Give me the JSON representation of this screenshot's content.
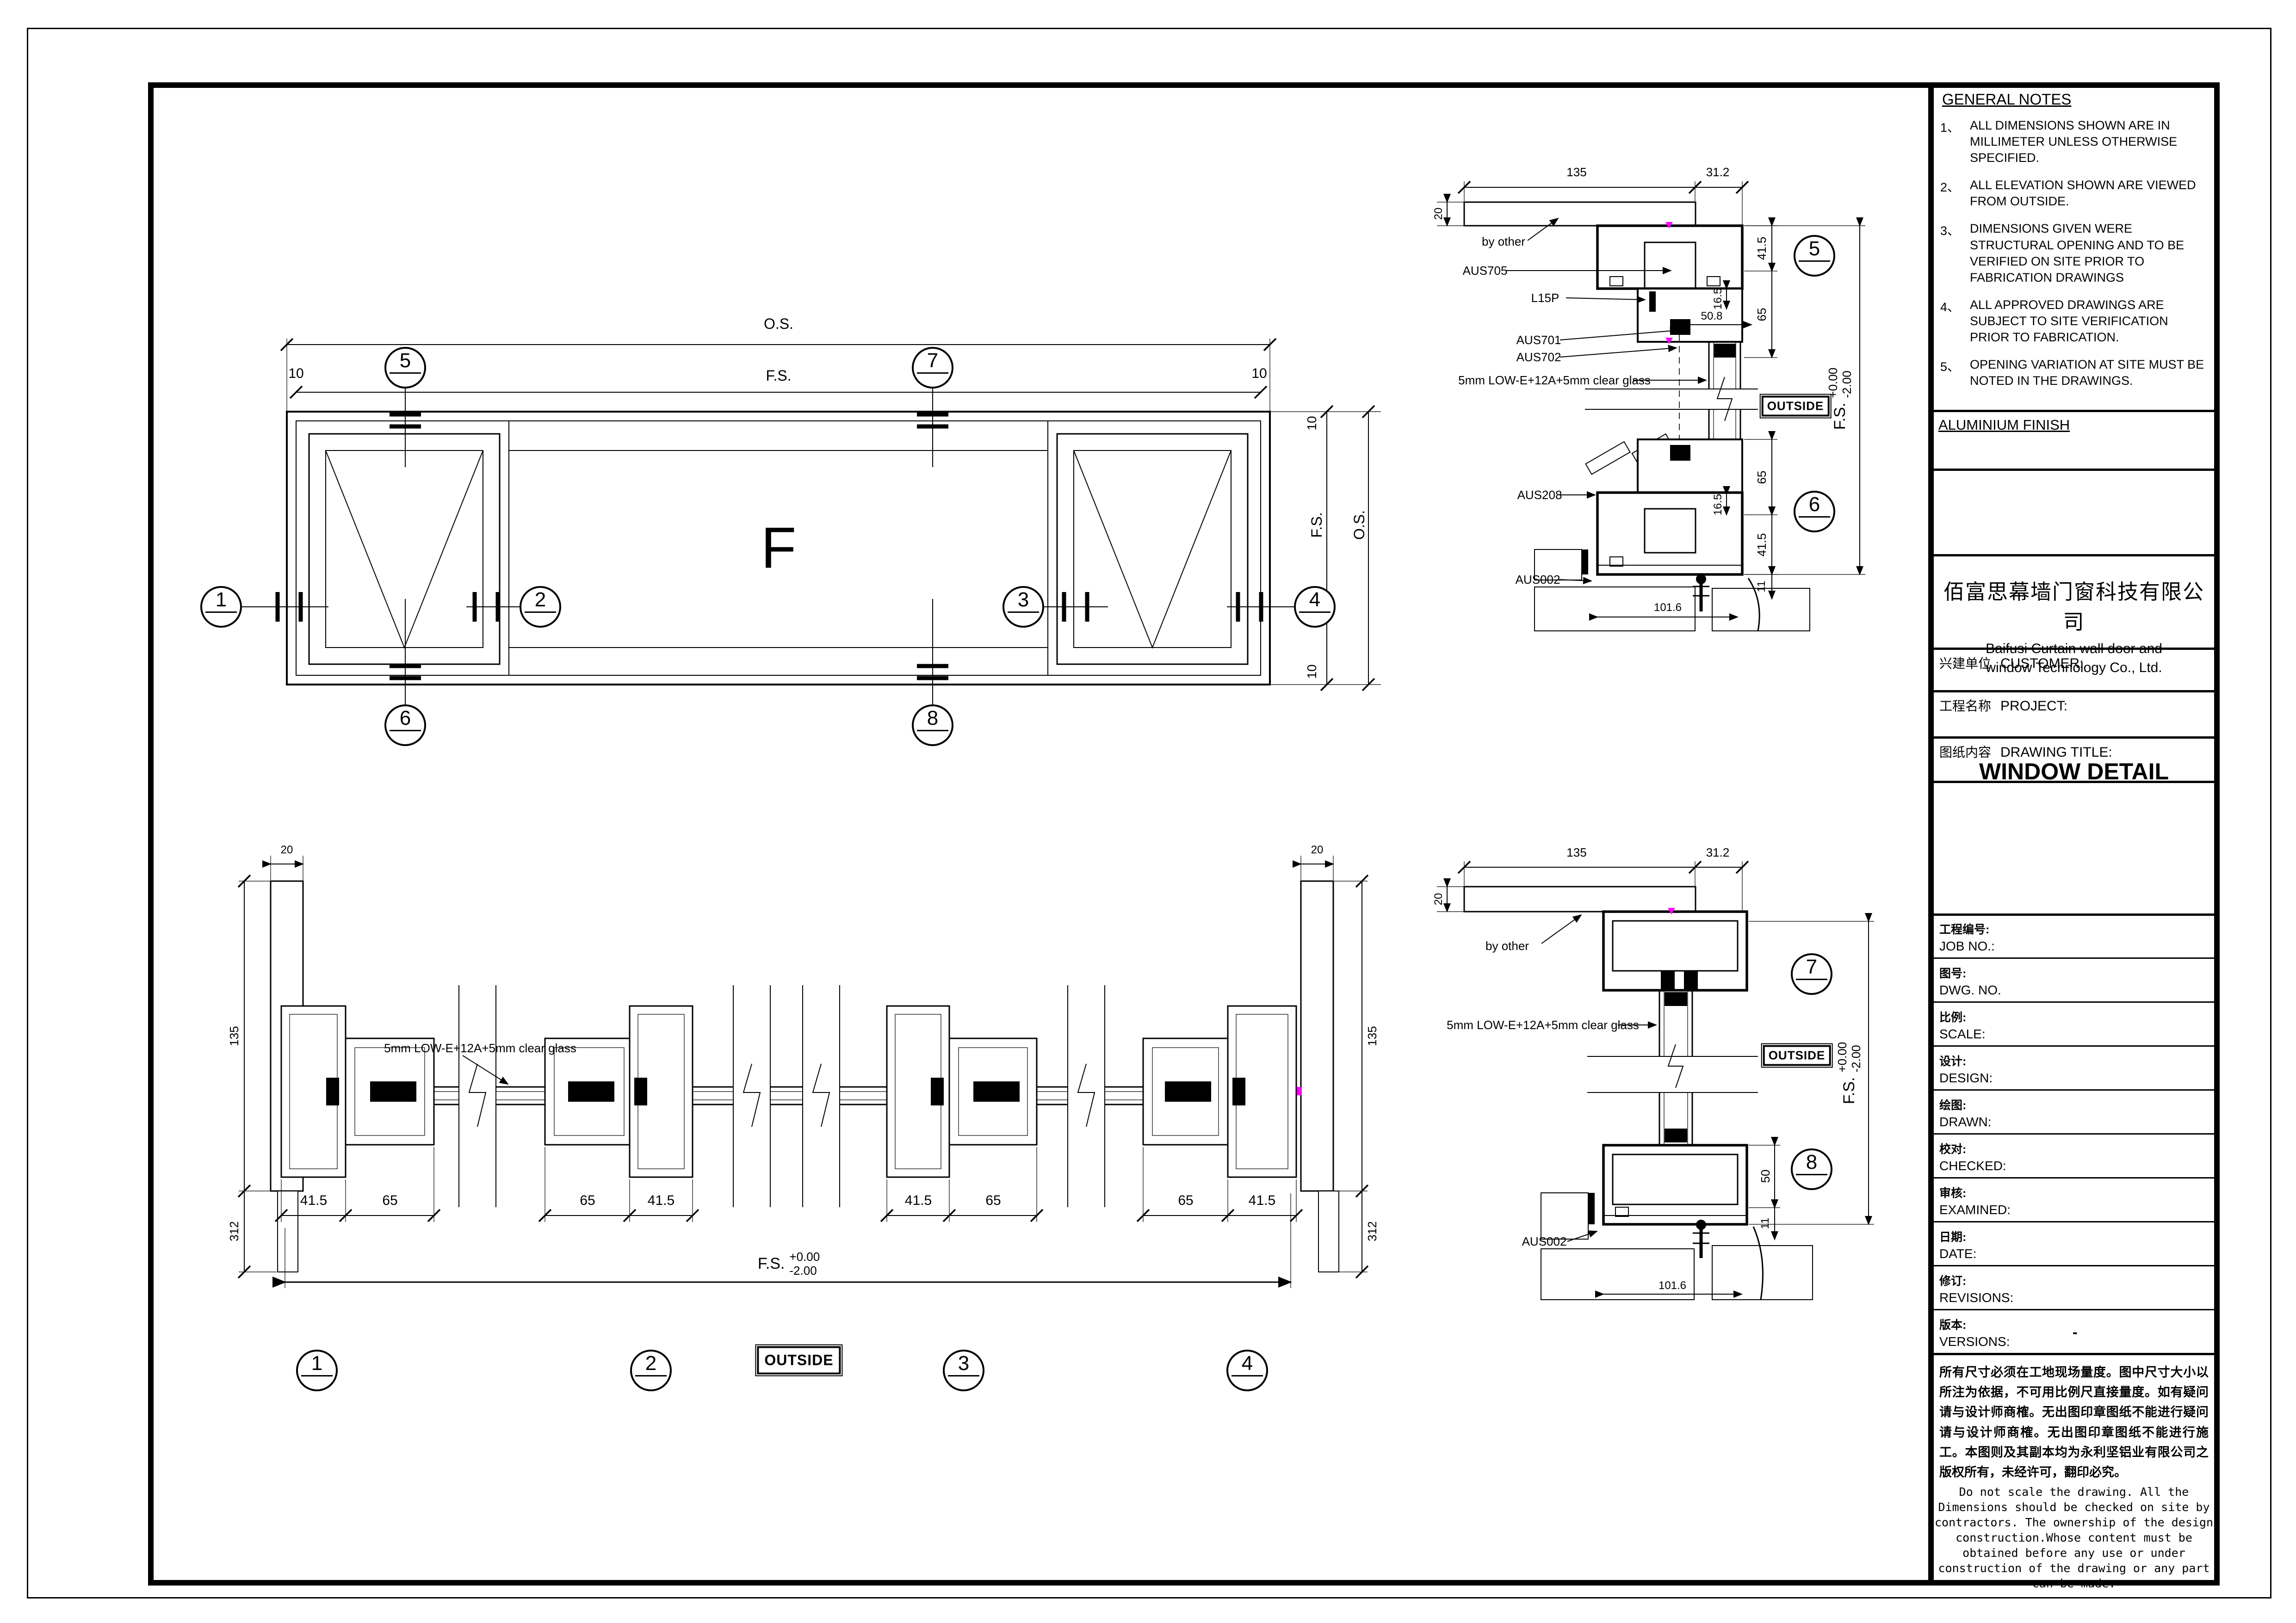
{
  "sheet": {
    "background": "#ffffff",
    "line_color": "#000000",
    "accent_color": "#ff00ff"
  },
  "title_block": {
    "general_notes": {
      "title": "GENERAL NOTES",
      "items": [
        {
          "num": "1、",
          "text": "ALL DIMENSIONS SHOWN ARE IN MILLIMETER UNLESS OTHERWISE SPECIFIED."
        },
        {
          "num": "2、",
          "text": "ALL ELEVATION SHOWN ARE VIEWED FROM OUTSIDE."
        },
        {
          "num": "3、",
          "text": "DIMENSIONS GIVEN WERE STRUCTURAL OPENING AND TO BE VERIFIED ON SITE PRIOR TO FABRICATION DRAWINGS"
        },
        {
          "num": "4、",
          "text": "ALL APPROVED DRAWINGS ARE SUBJECT TO SITE VERIFICATION PRIOR TO FABRICATION."
        },
        {
          "num": "5、",
          "text": "OPENING VARIATION AT SITE MUST BE NOTED IN THE DRAWINGS."
        }
      ]
    },
    "aluminium_finish_label": "ALUMINIUM  FINISH",
    "company": {
      "name_cn": "佰富思幕墙门窗科技有限公司",
      "name_en_line1": "Baifusi Curtain wall door and",
      "name_en_line2": "window Technology Co., Ltd."
    },
    "customer": {
      "label_cn": "兴建单位",
      "label_en": "CUSTOMER:"
    },
    "project": {
      "label_cn": "工程名称",
      "label_en": "PROJECT:"
    },
    "drawing_title": {
      "label_cn": "图纸内容",
      "label_en": "DRAWING TITLE:",
      "value": "WINDOW DETAIL"
    },
    "fields": [
      {
        "cn": "工程编号:",
        "en": "JOB NO.:",
        "value": ""
      },
      {
        "cn": "图号:",
        "en": "DWG. NO.",
        "value": ""
      },
      {
        "cn": "比例:",
        "en": "SCALE:",
        "value": ""
      },
      {
        "cn": "设计:",
        "en": "DESIGN:",
        "value": ""
      },
      {
        "cn": "绘图:",
        "en": "DRAWN:",
        "value": ""
      },
      {
        "cn": "校对:",
        "en": "CHECKED:",
        "value": ""
      },
      {
        "cn": "审核:",
        "en": "EXAMINED:",
        "value": ""
      },
      {
        "cn": "日期:",
        "en": "DATE:",
        "value": ""
      },
      {
        "cn": "修订:",
        "en": "REVISIONS:",
        "value": ""
      },
      {
        "cn": "版本:",
        "en": "VERSIONS:",
        "value": "-"
      }
    ],
    "disclaimer_cn": "所有尺寸必须在工地现场量度。图中尺寸大小以所注为依据，不可用比例尺直接量度。如有疑问请与设计师商榷。无出图印章图纸不能进行疑问请与设计师商榷。无出图印章图纸不能进行施工。本图则及其副本均为永利坚铝业有限公司之版权所有，未经许可，翻印必究。",
    "disclaimer_en": "Do not scale the drawing. All the\nDimensions  should be checked on site by\ncontractors. The ownership of the design\nconstruction.Whose content must be\nobtained before any use or under\nconstruction of the drawing or any part\ncan be made."
  },
  "elevation": {
    "panel_label": "F",
    "dim_os": "O.S.",
    "dim_fs": "F.S.",
    "dim_10": "10",
    "bubbles": {
      "b1": "1",
      "b2": "2",
      "b3": "3",
      "b4": "4",
      "b5": "5",
      "b6": "6",
      "b7": "7",
      "b8": "8"
    }
  },
  "details": {
    "by_other": "by other",
    "outside": "OUTSIDE",
    "glass_spec": "5mm LOW-E+12A+5mm clear glass",
    "profiles": {
      "aus705": "AUS705",
      "l15p": "L15P",
      "aus701": "AUS701",
      "aus702": "AUS702",
      "aus208": "AUS208",
      "aus002": "AUS002"
    },
    "level": {
      "fs": "F.S.",
      "upper": "+0.00",
      "lower": "-2.00"
    },
    "dims": {
      "d135": "135",
      "d31_2": "31.2",
      "d20": "20",
      "d41_5": "41.5",
      "d16_5": "16.5",
      "d65": "65",
      "d50_8": "50.8",
      "d50": "50",
      "d11": "11",
      "d101_6": "101.6",
      "d312": "312"
    }
  }
}
